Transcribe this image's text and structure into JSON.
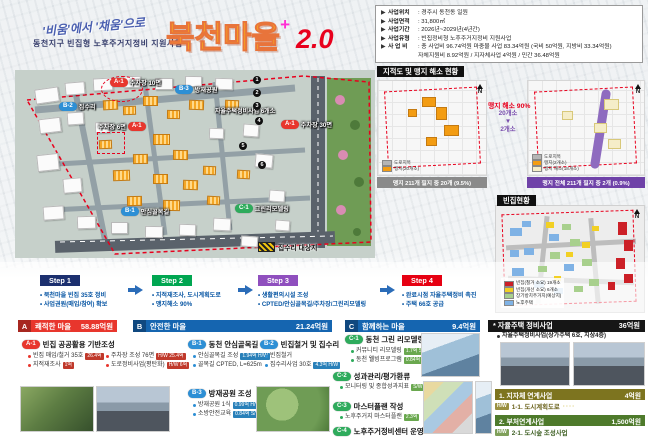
{
  "colors": {
    "accent_red": "#e8001d",
    "accent_blue": "#1565b0",
    "accent_green": "#2eab5c",
    "accent_purple": "#8f4fbe",
    "accent_navy": "#1b2f6e",
    "title_yellow": "#ffc20e"
  },
  "header": {
    "slogan": "'비움'에서 '채움'으로",
    "subtitle": "동천지구 빈집형 노후주거지정비 지원사업",
    "title_main": "북천마을",
    "title_plus": "+",
    "title_version": "2.0"
  },
  "info_box": {
    "rows": [
      {
        "arrow": "▶",
        "label": "사업위치",
        "value": ": 경주시 동천동 일원"
      },
      {
        "arrow": "▶",
        "label": "사업면적",
        "value": ": 31,800㎡"
      },
      {
        "arrow": "▶",
        "label": "사업기간",
        "value": ": 2026년~2029년(4년간)"
      },
      {
        "arrow": "▶",
        "label": "사업유형",
        "value": ": 빈집정비형 노후주거지정비 지원사업"
      },
      {
        "arrow": "▶",
        "label": "사 업 비",
        "value": ": 총 사업비 96.74억원 마중물 사업 83.34억원 (국비 50억원, 지방비 33.34억원)"
      },
      {
        "arrow": "",
        "label": "",
        "value": "자체지원비 8.92억원 / 지자체사업 4억원 / 민간 36.48억원"
      }
    ]
  },
  "cadastral": {
    "title": "지적도 및 맹지 해소 현황",
    "annotation": "맹지 해소 90%",
    "before_count": "20개소",
    "arrow_down": "▼",
    "after_count": "2개소",
    "left_caption": "맹지 211개 필지 중 20개 (9.5%)",
    "right_caption": "맹지 전체 211개 필지 중 2개 (0.9%)",
    "left_legend": [
      {
        "color": "#b5b5b5",
        "label": "도로지목"
      },
      {
        "color": "#f39c12",
        "label": "맹지(20개소)"
      }
    ],
    "right_legend": [
      {
        "color": "#b5b5b5",
        "label": "도로지목"
      },
      {
        "color": "#f39c12",
        "label": "맹지(2개소)"
      },
      {
        "color": "#f5edc8",
        "label": "맹지 해소(18개소)"
      }
    ],
    "compass": "N"
  },
  "vacant": {
    "title": "빈집현황",
    "compass": "N",
    "legend": [
      {
        "color": "#cc2027",
        "label": "빈집(철거 소요) 19개소"
      },
      {
        "color": "#f2d024",
        "label": "빈집(개선 소요) 6개소"
      },
      {
        "color": "#a8d08d",
        "label": "장기방치주거지(예상지)"
      },
      {
        "color": "#7fb2e5",
        "label": "노후주택"
      }
    ]
  },
  "site_map": {
    "labels": [
      {
        "tag": "A-1",
        "text": "주차장 10면"
      },
      {
        "tag": "B-2",
        "text": "집수리"
      },
      {
        "tag": "B-3",
        "text": "방재공원"
      },
      {
        "tag": "A-1",
        "text": "주차장 6면"
      },
      {
        "tag": "A-1",
        "text": "주차장 30면"
      },
      {
        "tag": "B-1",
        "text": "안심골목길"
      },
      {
        "tag": "C-1",
        "text": "그린리모델링"
      }
    ],
    "note": "자율주택정비사업 6개소",
    "numbers": [
      "1",
      "2",
      "3",
      "4",
      "5",
      "6"
    ],
    "repair_legend": "집수리 대상지",
    "compass": "N"
  },
  "steps": [
    {
      "label": "Step 1",
      "bullets": [
        "북천마을 빈집 35호 정비",
        "사업권원(매입/참여) 확보"
      ]
    },
    {
      "label": "Step 2",
      "bullets": [
        "지적재조사, 도시계획도로",
        "맹지해소 90%"
      ]
    },
    {
      "label": "Step 3",
      "bullets": [
        "생활편의시설 조성",
        "CPTED/안심골목길/주차장/그린리모델링"
      ]
    },
    {
      "label": "Step 4",
      "bullets": [
        "완료시점 자율주택정비 촉진",
        "주택 66호 공급"
      ]
    }
  ],
  "sections": {
    "a": {
      "letter": "A",
      "title": "쾌적한 마을",
      "budget": "58.88억원"
    },
    "b": {
      "letter": "B",
      "title": "안전한 마을",
      "budget": "21.24억원"
    },
    "c": {
      "letter": "C",
      "title": "함께하는 마을",
      "budget": "9.4억원"
    },
    "jayul": {
      "title": "* 자율주택 정비사업",
      "budget": "36억원",
      "bullet": "자율주택정비사업(상가주택 6호, 지상4층)"
    }
  },
  "subsections": {
    "a1": {
      "tag": "A-1",
      "title": "빈집 공공활용 기반조성",
      "col1": [
        {
          "text": "빈집 매입/철거 35호",
          "badge": "26.4억"
        },
        {
          "text": "지적재조사",
          "badge": "1억"
        }
      ],
      "col2": [
        {
          "text": "주차장 조성 76면",
          "badge": "H/W 25.4억"
        },
        {
          "text": "도로정비사업(평탄화)",
          "badge": "H/W 6억"
        }
      ]
    },
    "b1": {
      "tag": "B-1",
      "title": "동천 안심골목길",
      "items": [
        {
          "text": "안심골목길 조성",
          "badge": "1.94억 H/W"
        },
        {
          "text": "골목길 CPTED, L=625m",
          "badge": ""
        }
      ]
    },
    "b2": {
      "tag": "B-2",
      "title": "빈집철거 및 집수리",
      "items": [
        {
          "text": "빈집철거",
          "badge": ""
        },
        {
          "text": "집수리사업 30호",
          "badge": "4.3억 H/W"
        }
      ]
    },
    "b3": {
      "tag": "B-3",
      "title": "방재공원 조성",
      "items": [
        {
          "text": "방재공원 1식",
          "badge": "0.99억 H/W"
        },
        {
          "text": "소방안전교육",
          "badge": "0.84억 S/W"
        }
      ]
    },
    "c1": {
      "tag": "C-1",
      "title": "동천 그린 리모델링",
      "items": [
        {
          "text": "커뮤니티 리모델링",
          "badge": "1.7억 S/W"
        },
        {
          "text": "동천 웰빙프로그램",
          "badge": "0.84억 S/W"
        }
      ]
    },
    "c2": {
      "tag": "C-2",
      "title": "성과관리/평가환류",
      "items": [
        {
          "text": "모니터링 및 종합성과지표",
          "badge": "S/W"
        }
      ]
    },
    "c3": {
      "tag": "C-3",
      "title": "마스터플랜 작성",
      "items": [
        {
          "text": "노후주거지 마스터플랜",
          "badge": "2.3억"
        }
      ]
    },
    "c4": {
      "tag": "C-4",
      "title": "노후주거정비센터 운영",
      "items": []
    }
  },
  "linked_projects": [
    {
      "tag": "H/W",
      "title": "1. 지자체 연계사업",
      "budget": "4억원",
      "item": "1-1. 도시계획도로",
      "trail": "····"
    },
    {
      "tag": "H/W",
      "title": "2. 부처연계사업",
      "budget": "1,500억원",
      "item": "2-1. 도시숲 조성사업",
      "trail": ""
    }
  ]
}
